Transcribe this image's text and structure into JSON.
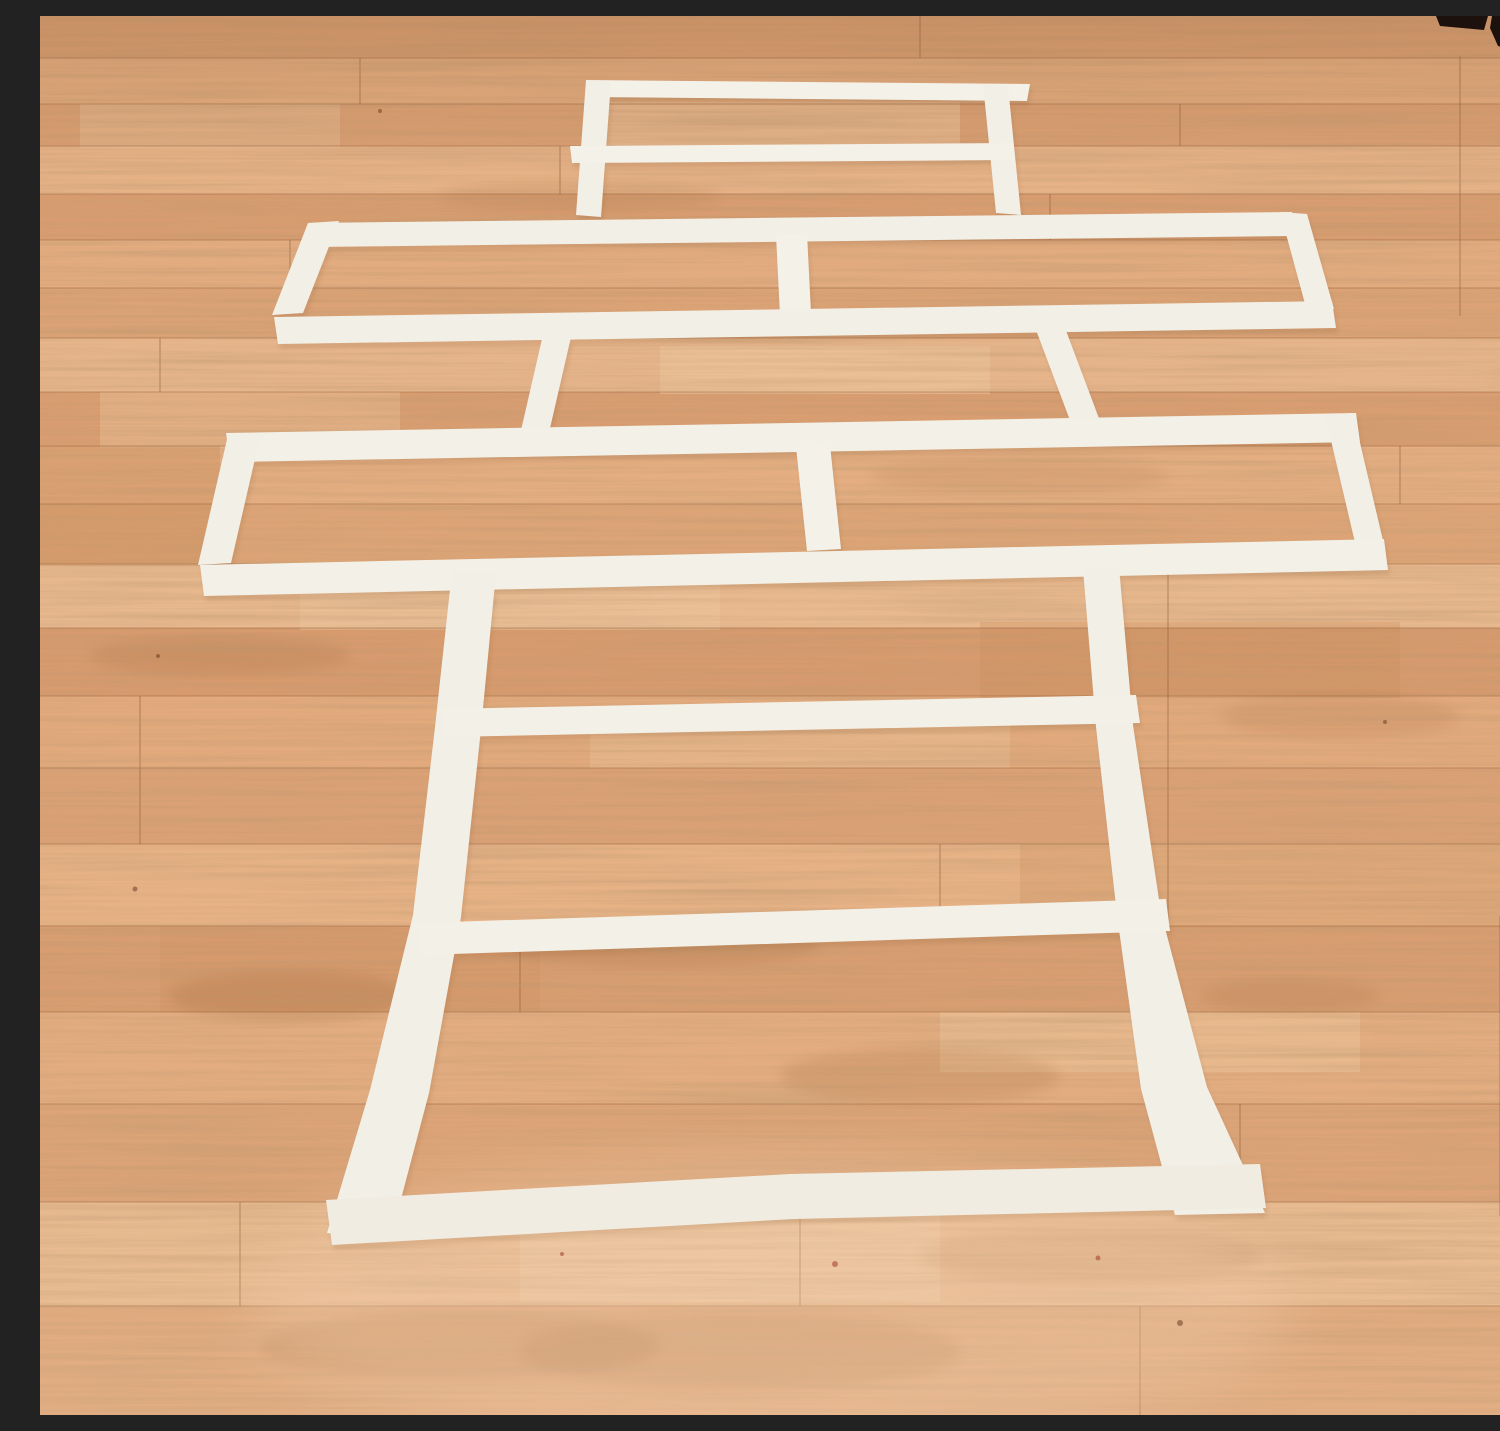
{
  "scene": {
    "description": "Photograph of a hopscotch court laid out with white masking tape on a light oak laminate wood floor, viewed in perspective from standing height",
    "subject": "hopscotch-court",
    "surface": "oak-laminate-floor",
    "court_cells": 10,
    "rows_far_to_near": [
      "top box split into two stacked cells",
      "two wide side-by-side cells",
      "one single center cell",
      "two wide side-by-side cells",
      "three stacked cells widening toward viewer"
    ]
  },
  "palette": {
    "wood_base": "#dfa377",
    "wood_light": "#ecc29a",
    "wood_dark": "#cf9160",
    "seam": "rgba(146,92,58,0.32)",
    "joint": "rgba(140,88,55,0.30)",
    "tape": "#f2efe6",
    "tape_bright": "#f4f1e9",
    "tape_dim": "#f0ece1",
    "tape_shadow": "#8a5c36",
    "grain": "#7d4e2a",
    "knot": "#8a5228",
    "flash_glow": "#f6d2b0",
    "corner_object": "#1c110c",
    "speck": "#6b3f22",
    "red_speck": "#a33b28"
  },
  "floor": {
    "planks": [
      {
        "y": 0,
        "h": 42,
        "color": "#d99f72"
      },
      {
        "y": 42,
        "h": 46,
        "color": "#e2ab7e"
      },
      {
        "y": 88,
        "h": 42,
        "color": "#daa073"
      },
      {
        "y": 130,
        "h": 48,
        "color": "#e6b287"
      },
      {
        "y": 178,
        "h": 46,
        "color": "#d89d70"
      },
      {
        "y": 224,
        "h": 48,
        "color": "#e3ac80"
      },
      {
        "y": 272,
        "h": 50,
        "color": "#dba376"
      },
      {
        "y": 322,
        "h": 54,
        "color": "#e7b58b"
      },
      {
        "y": 376,
        "h": 54,
        "color": "#d99e71"
      },
      {
        "y": 430,
        "h": 58,
        "color": "#e4ae82"
      },
      {
        "y": 488,
        "h": 60,
        "color": "#dda577"
      },
      {
        "y": 548,
        "h": 64,
        "color": "#e8b88e"
      },
      {
        "y": 612,
        "h": 68,
        "color": "#d79b6e"
      },
      {
        "y": 680,
        "h": 72,
        "color": "#e2aa7d"
      },
      {
        "y": 752,
        "h": 76,
        "color": "#dba176"
      },
      {
        "y": 828,
        "h": 82,
        "color": "#e6b286"
      },
      {
        "y": 910,
        "h": 86,
        "color": "#d89e71"
      },
      {
        "y": 996,
        "h": 92,
        "color": "#e3ad81"
      },
      {
        "y": 1088,
        "h": 98,
        "color": "#dca478"
      },
      {
        "y": 1186,
        "h": 104,
        "color": "#e8ba90"
      },
      {
        "y": 1290,
        "h": 109,
        "color": "#dfa87c"
      }
    ],
    "patches": [
      {
        "x": 560,
        "y": 86,
        "w": 360,
        "h": 46,
        "color": "#ecc29a",
        "opacity": 0.55
      },
      {
        "x": 40,
        "y": 88,
        "w": 260,
        "h": 44,
        "color": "#ecc29a",
        "opacity": 0.4
      },
      {
        "x": 620,
        "y": 330,
        "w": 330,
        "h": 48,
        "color": "#eec79f",
        "opacity": 0.55
      },
      {
        "x": 60,
        "y": 376,
        "w": 300,
        "h": 56,
        "color": "#ecc29a",
        "opacity": 0.45
      },
      {
        "x": 0,
        "y": 430,
        "w": 180,
        "h": 120,
        "color": "#c4854f",
        "opacity": 0.3
      },
      {
        "x": 260,
        "y": 548,
        "w": 420,
        "h": 66,
        "color": "#eec79f",
        "opacity": 0.45
      },
      {
        "x": 940,
        "y": 606,
        "w": 420,
        "h": 76,
        "color": "#c98e5c",
        "opacity": 0.3
      },
      {
        "x": 980,
        "y": 828,
        "w": 520,
        "h": 84,
        "color": "#c98e5c",
        "opacity": 0.28
      },
      {
        "x": 900,
        "y": 996,
        "w": 420,
        "h": 60,
        "color": "#efc79e",
        "opacity": 0.45
      },
      {
        "x": 480,
        "y": 1186,
        "w": 420,
        "h": 100,
        "color": "#f0cda6",
        "opacity": 0.45
      },
      {
        "x": 550,
        "y": 700,
        "w": 420,
        "h": 52,
        "color": "#eec39b",
        "opacity": 0.4
      },
      {
        "x": 120,
        "y": 910,
        "w": 380,
        "h": 86,
        "color": "#cf9160",
        "opacity": 0.25
      }
    ],
    "joints": [
      {
        "x": 320,
        "y1": 42,
        "y2": 88
      },
      {
        "x": 880,
        "y1": 0,
        "y2": 42
      },
      {
        "x": 1140,
        "y1": 88,
        "y2": 130
      },
      {
        "x": 520,
        "y1": 130,
        "y2": 178
      },
      {
        "x": 1010,
        "y1": 178,
        "y2": 224
      },
      {
        "x": 250,
        "y1": 224,
        "y2": 272
      },
      {
        "x": 1420,
        "y1": 40,
        "y2": 300
      },
      {
        "x": 120,
        "y1": 322,
        "y2": 376
      },
      {
        "x": 1360,
        "y1": 430,
        "y2": 488
      },
      {
        "x": 480,
        "y1": 910,
        "y2": 996
      },
      {
        "x": 900,
        "y1": 828,
        "y2": 910
      },
      {
        "x": 1200,
        "y1": 1088,
        "y2": 1186
      },
      {
        "x": 350,
        "y1": 996,
        "y2": 1088
      },
      {
        "x": 760,
        "y1": 1186,
        "y2": 1290
      },
      {
        "x": 1100,
        "y1": 1290,
        "y2": 1399
      },
      {
        "x": 200,
        "y1": 1186,
        "y2": 1290
      },
      {
        "x": 1128,
        "y1": 548,
        "y2": 910
      },
      {
        "x": 1460,
        "y1": 900,
        "y2": 1200
      },
      {
        "x": 100,
        "y1": 680,
        "y2": 828
      }
    ],
    "knots": [
      {
        "cx": 250,
        "cy": 980,
        "rx": 120,
        "ry": 26,
        "opacity": 0.16
      },
      {
        "cx": 620,
        "cy": 930,
        "rx": 160,
        "ry": 22,
        "opacity": 0.14
      },
      {
        "cx": 880,
        "cy": 1060,
        "rx": 140,
        "ry": 28,
        "opacity": 0.15
      },
      {
        "cx": 420,
        "cy": 1330,
        "rx": 200,
        "ry": 35,
        "opacity": 0.16
      },
      {
        "cx": 1050,
        "cy": 1240,
        "rx": 170,
        "ry": 30,
        "opacity": 0.12
      },
      {
        "cx": 180,
        "cy": 640,
        "rx": 130,
        "ry": 20,
        "opacity": 0.13
      },
      {
        "cx": 1300,
        "cy": 700,
        "rx": 120,
        "ry": 22,
        "opacity": 0.12
      },
      {
        "cx": 700,
        "cy": 1335,
        "rx": 220,
        "ry": 40,
        "opacity": 0.14
      },
      {
        "cx": 1250,
        "cy": 980,
        "rx": 90,
        "ry": 18,
        "opacity": 0.12
      },
      {
        "cx": 540,
        "cy": 180,
        "rx": 140,
        "ry": 16,
        "opacity": 0.1
      },
      {
        "cx": 980,
        "cy": 460,
        "rx": 150,
        "ry": 18,
        "opacity": 0.1
      }
    ],
    "specks": [
      {
        "x": 95,
        "y": 873,
        "r": 2.5,
        "color": "#6b3f22"
      },
      {
        "x": 1140,
        "y": 1307,
        "r": 3,
        "color": "#6b3f22"
      },
      {
        "x": 1345,
        "y": 706,
        "r": 2,
        "color": "#6b3f22"
      },
      {
        "x": 118,
        "y": 640,
        "r": 2,
        "color": "#6b3f22"
      },
      {
        "x": 340,
        "y": 95,
        "r": 2,
        "color": "#6b3f22"
      },
      {
        "x": 795,
        "y": 1248,
        "r": 3,
        "color": "#a33b28"
      },
      {
        "x": 1058,
        "y": 1242,
        "r": 2.5,
        "color": "#a33b28"
      },
      {
        "x": 522,
        "y": 1238,
        "r": 2,
        "color": "#a33b28"
      }
    ]
  },
  "court": {
    "tapes": [
      {
        "id": "top-box-top",
        "color": "#f4f1e9",
        "points": "546,64 990,68 987,85 549,81"
      },
      {
        "id": "top-box-left",
        "color": "#f2efe6",
        "points": "546,64 571,66 561,201 536,199"
      },
      {
        "id": "top-box-right",
        "color": "#f2efe6",
        "points": "943,68 968,70 981,199 956,197"
      },
      {
        "id": "top-box-mid",
        "color": "#f4f1e9",
        "points": "530,130 973,127 975,144 532,147"
      },
      {
        "id": "row1-top",
        "color": "#f2efe6",
        "points": "268,207 1252,196 1255,220 271,231"
      },
      {
        "id": "row1-left",
        "color": "#f2efe6",
        "points": "268,207 299,205 263,297 232,299"
      },
      {
        "id": "row1-right",
        "color": "#f2efe6",
        "points": "1240,196 1267,198 1294,293 1267,295"
      },
      {
        "id": "row1-mid",
        "color": "#f4f1e9",
        "points": "736,219 767,217 771,297 740,299"
      },
      {
        "id": "row1-bottom",
        "color": "#f2efe6",
        "points": "234,301 1292,285 1296,312 238,328"
      },
      {
        "id": "cell-left",
        "color": "#f2efe6",
        "points": "505,310 534,308 508,421 479,423"
      },
      {
        "id": "cell-right",
        "color": "#f2efe6",
        "points": "993,306 1022,304 1063,413 1034,415"
      },
      {
        "id": "row2-top",
        "color": "#f3f0e7",
        "points": "186,417 1316,397 1320,426 190,446"
      },
      {
        "id": "row2-left",
        "color": "#f2efe6",
        "points": "188,419 221,417 191,547 158,549"
      },
      {
        "id": "row2-right",
        "color": "#f2efe6",
        "points": "1285,399 1313,397 1345,533 1317,535"
      },
      {
        "id": "row2-mid",
        "color": "#f4f1e9",
        "points": "756,431 790,429 801,533 767,535"
      },
      {
        "id": "row2-bottom",
        "color": "#f3f0e7",
        "points": "160,549 1344,523 1348,554 164,580"
      },
      {
        "id": "col-left",
        "color": "#f2efe6",
        "points": "412,555 456,557 441,713 421,901 389,1077 351,1221 287,1217 330,1074 373,899 395,711"
      },
      {
        "id": "col-right",
        "color": "#f2efe6",
        "points": "1043,553 1079,551 1093,709 1121,897 1167,1071 1225,1197 1135,1199 1101,1073 1077,899 1056,711"
      },
      {
        "id": "col-h1",
        "color": "#f3f0e7",
        "points": "402,693 1096,679 1100,707 406,721"
      },
      {
        "id": "col-h2",
        "color": "#f3f0e7",
        "points": "377,907 1126,883 1130,915 381,939"
      },
      {
        "id": "col-bottom",
        "color": "#f0ece1",
        "points": "286,1184 750,1158 1220,1148 1226,1192 754,1203 292,1229"
      }
    ]
  },
  "corner_object": {
    "polygons": [
      {
        "points": "1396,0 1448,0 1444,14 1400,10",
        "color": "#1c110c"
      },
      {
        "points": "1452,0 1500,0 1500,20 1480,36 1458,30 1450,12",
        "color": "#1c110c"
      }
    ]
  }
}
